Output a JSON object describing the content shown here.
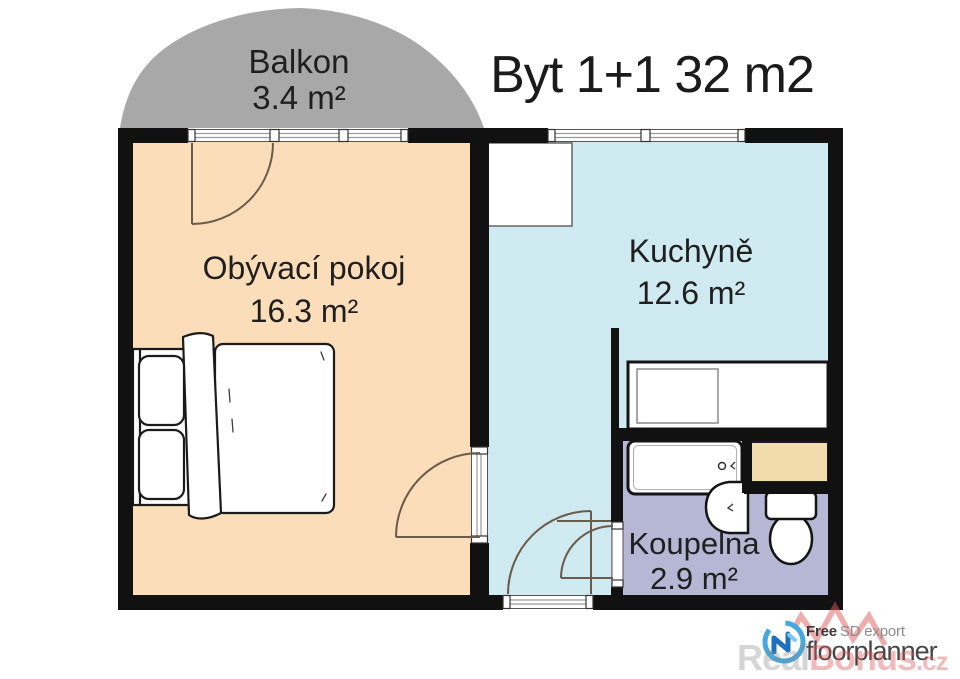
{
  "title": "Byt 1+1 32 m2",
  "rooms": {
    "balcony": {
      "name": "Balkon",
      "area": "3.4 m²"
    },
    "living_room": {
      "name": "Obývací pokoj",
      "area": "16.3 m²"
    },
    "kitchen": {
      "name": "Kuchyně",
      "area": "12.6 m²"
    },
    "bathroom": {
      "name": "Koupelna",
      "area": "2.9 m²"
    }
  },
  "furniture_icons": [
    "double-bed-icon",
    "pillow-icon",
    "fridge-icon",
    "kitchen-counter-icon",
    "sink-unit-icon",
    "bathtub-icon",
    "washbasin-icon",
    "toilet-icon",
    "washing-machine-icon"
  ],
  "branding": {
    "free": "Free",
    "sd_export": "SD export",
    "product": "floorplanner"
  },
  "watermark": {
    "part1": "Real",
    "part2": "Bonus",
    "part3": ".cz"
  },
  "palette": {
    "wall": "#111111",
    "balcony": "#a8a8a8",
    "living_room": "#fbddb9",
    "kitchen": "#cfeaf0",
    "bathroom": "#b6b7d5",
    "washer": "#f2dcae",
    "door_arc": "#6b5b4a",
    "window_frame": "#555555",
    "brand_blue": "#47a8dd",
    "brand_blue_dark": "#1e6fc0",
    "watermark_red": "rgba(224,90,90,0.5)"
  }
}
